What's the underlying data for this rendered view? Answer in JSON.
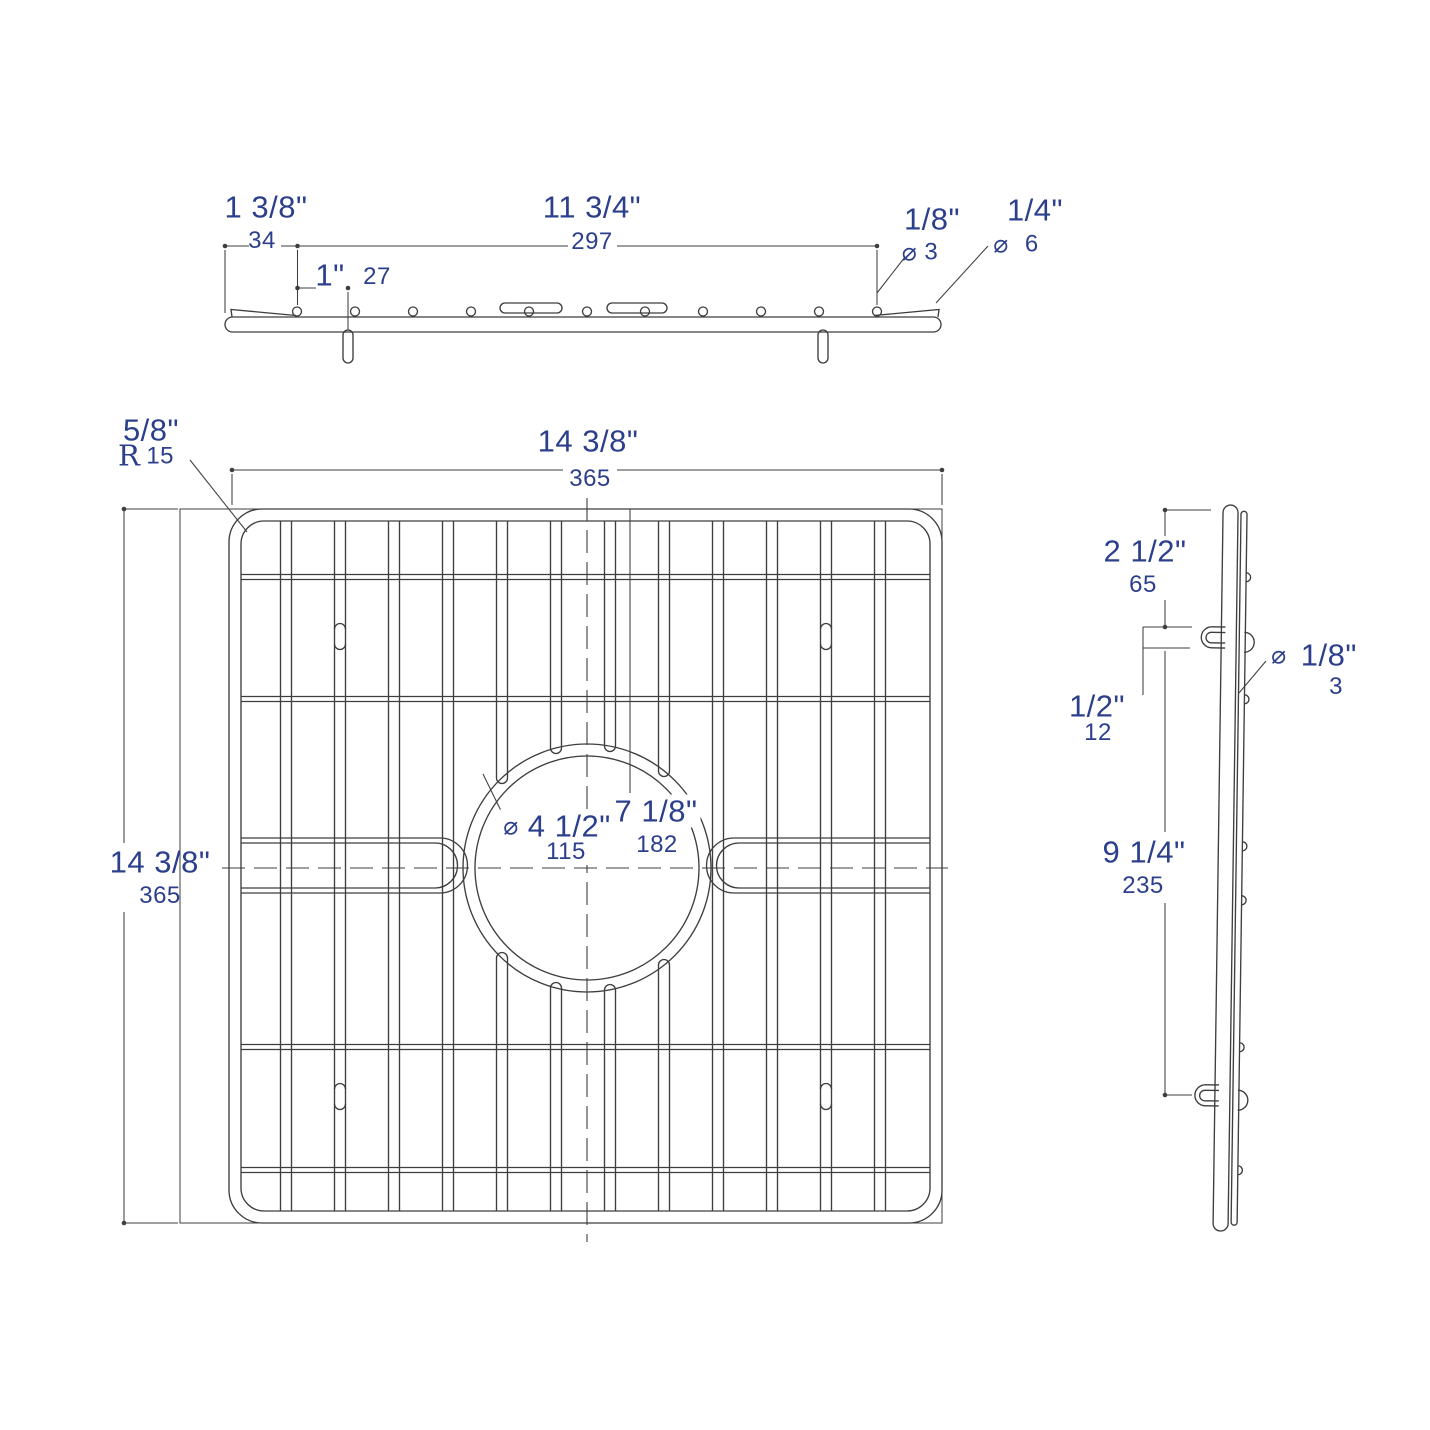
{
  "colors": {
    "dimension_text": "#2c3f8c",
    "line": "#3e3e3e",
    "background": "#ffffff"
  },
  "views": {
    "profile": {
      "end_offset": {
        "inches": "1 3/8\"",
        "mm": "34"
      },
      "pin_span": {
        "inches": "11 3/4\"",
        "mm": "297"
      },
      "pin_pitch": {
        "inches": "1\"",
        "mm": "27"
      },
      "pin_diameter": {
        "symbol": "⌀",
        "inches": "1/8\"",
        "mm": "3"
      },
      "frame_wire_diameter": {
        "symbol": "⌀",
        "inches": "1/4\"",
        "mm": "6"
      }
    },
    "plan": {
      "corner_radius": {
        "prefix": "R",
        "inches": "5/8\"",
        "mm": "15"
      },
      "overall_width": {
        "inches": "14 3/8\"",
        "mm": "365"
      },
      "overall_depth": {
        "inches": "14 3/8\"",
        "mm": "365"
      },
      "drain_opening_diameter": {
        "symbol": "⌀",
        "inches": "4 1/2\"",
        "mm": "115"
      },
      "center_offset": {
        "inches": "7 1/8\"",
        "mm": "182"
      }
    },
    "side": {
      "top_to_foot": {
        "inches": "2 1/2\"",
        "mm": "65"
      },
      "foot_height": {
        "inches": "1/2\"",
        "mm": "12"
      },
      "cross_wire_diameter": {
        "symbol": "⌀",
        "inches": "1/8\"",
        "mm": "3"
      },
      "foot_span": {
        "inches": "9 1/4\"",
        "mm": "235"
      }
    }
  }
}
